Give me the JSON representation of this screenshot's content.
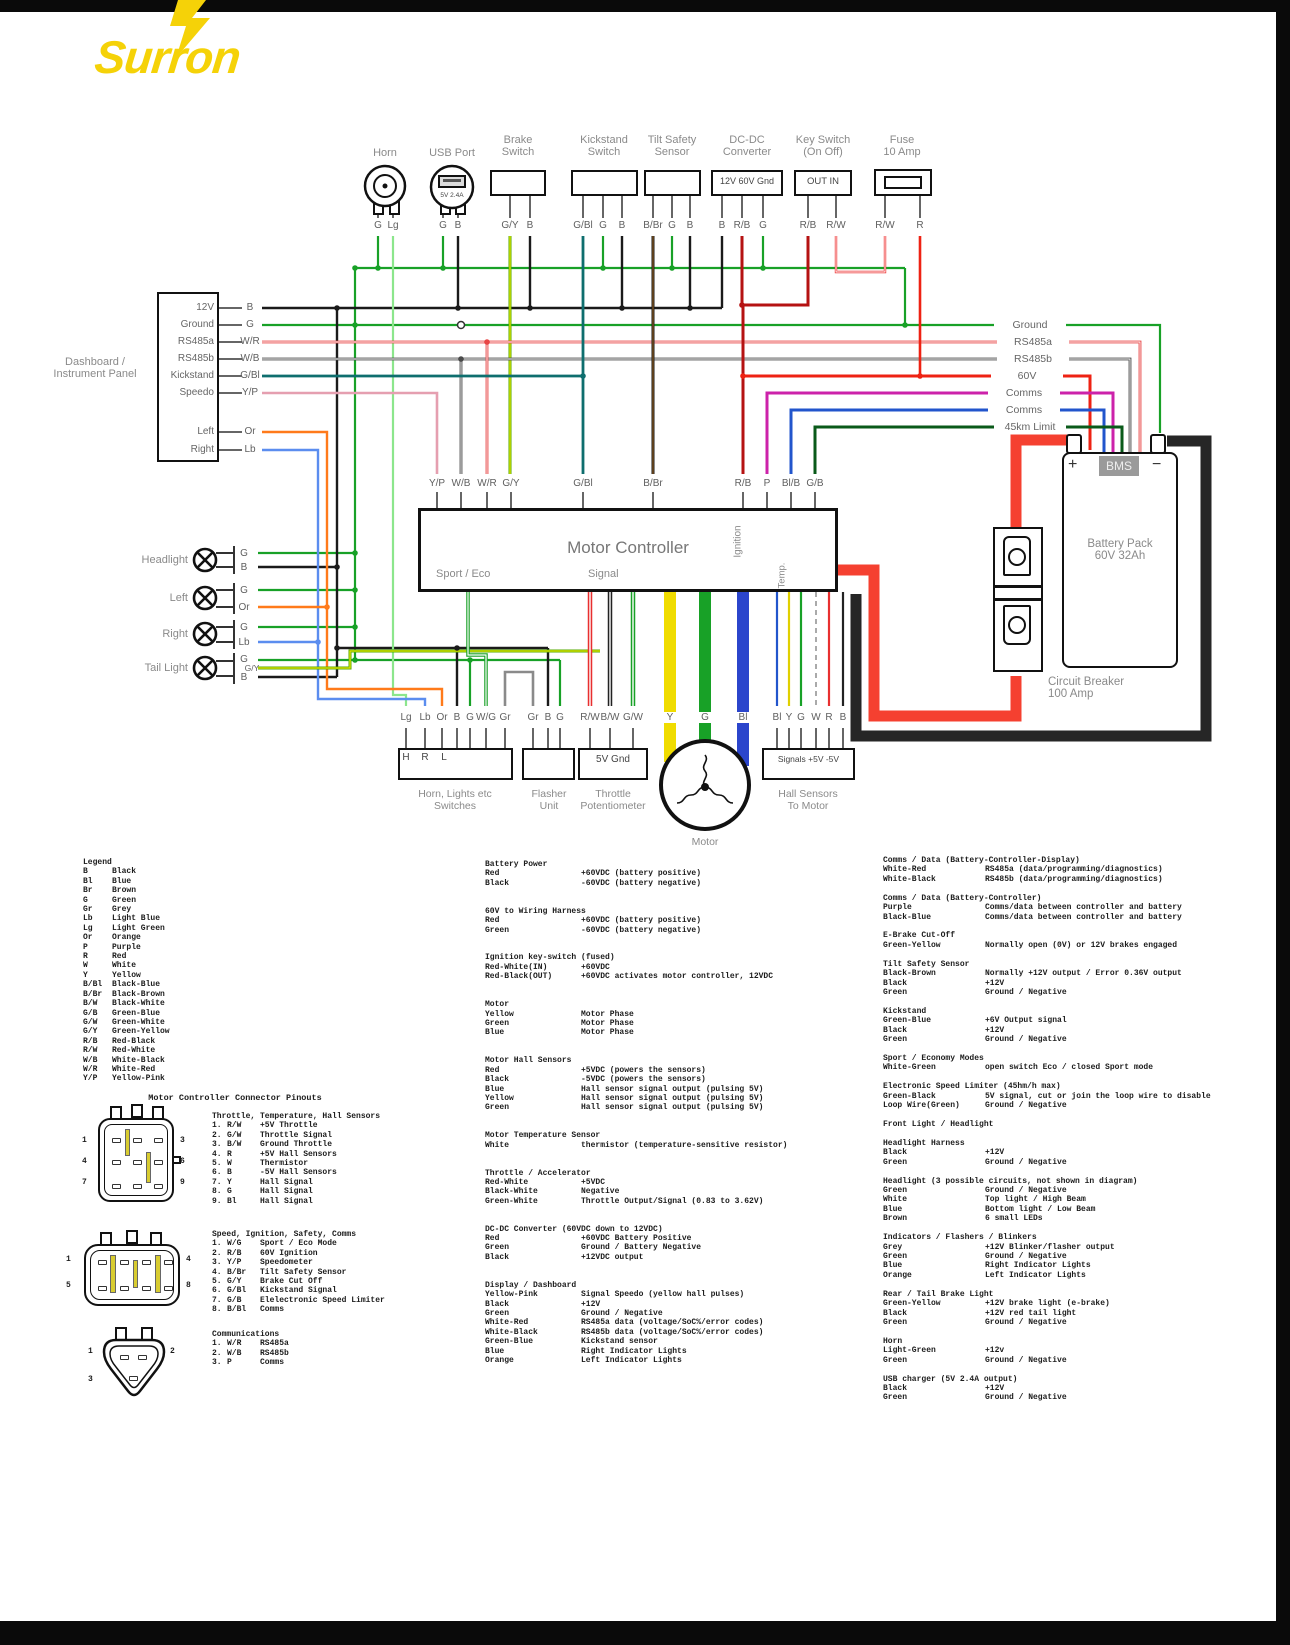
{
  "logo": "Surron",
  "wire_colors": {
    "black": "#1a1a1a",
    "green": "#18a127",
    "light_green": "#8ce68c",
    "light_blue": "#5b8def",
    "orange": "#ff7a1a",
    "red": "#ee2213",
    "dark_red": "#b51212",
    "green_blue": "#0e6e6e",
    "yellow_pink": "#e59fb0",
    "purple": "#cc22aa",
    "blue": "#2255cc",
    "dark_green": "#0a5a1a",
    "grey": "#8a8a8a",
    "yellow": "#f0dc00",
    "brand_yellow": "#f5d208"
  },
  "top_components": [
    {
      "label": "Horn",
      "label2": "",
      "pins": [
        "G",
        "Lg"
      ]
    },
    {
      "label": "USB Port",
      "label2": "",
      "inner": "5V 2.4A",
      "pins": [
        "G",
        "B"
      ]
    },
    {
      "label": "Brake",
      "label2": "Switch",
      "pins": [
        "G/Y",
        "B"
      ]
    },
    {
      "label": "Kickstand",
      "label2": "Switch",
      "pins": [
        "G/Bl",
        "G",
        "B"
      ]
    },
    {
      "label": "Tilt Safety",
      "label2": "Sensor",
      "pins": [
        "B/Br",
        "G",
        "B"
      ]
    },
    {
      "label": "DC-DC",
      "label2": "Converter",
      "inner": "12V 60V Gnd",
      "pins": [
        "B",
        "R/B",
        "G"
      ]
    },
    {
      "label": "Key Switch",
      "label2": "(On Off)",
      "inner": "OUT   IN",
      "pins": [
        "R/B",
        "R/W"
      ]
    },
    {
      "label": "Fuse",
      "label2": "10 Amp",
      "pins": [
        "R/W",
        "R"
      ]
    }
  ],
  "dashboard": {
    "label_line1": "Dashboard /",
    "label_line2": "Instrument Panel",
    "rows": [
      {
        "name": "12V",
        "pin": "B"
      },
      {
        "name": "Ground",
        "pin": "G"
      },
      {
        "name": "RS485a",
        "pin": "W/R"
      },
      {
        "name": "RS485b",
        "pin": "W/B"
      },
      {
        "name": "Kickstand",
        "pin": "G/Bl"
      },
      {
        "name": "Speedo",
        "pin": "Y/P"
      },
      {
        "name": "Left",
        "pin": "Or"
      },
      {
        "name": "Right",
        "pin": "Lb"
      }
    ]
  },
  "lights": [
    {
      "label": "Headlight",
      "pins": [
        "G",
        "B"
      ]
    },
    {
      "label": "Left",
      "pins": [
        "G",
        "Or"
      ]
    },
    {
      "label": "Right",
      "pins": [
        "G",
        "Lb"
      ]
    },
    {
      "label": "Tail Light",
      "pins": [
        "G",
        "G/Y",
        "B"
      ]
    }
  ],
  "bus_labels": [
    "Ground",
    "RS485a",
    "RS485b",
    "60V",
    "Comms",
    "Comms",
    "45km Limit"
  ],
  "controller": {
    "title": "Motor Controller",
    "sport": "Sport / Eco",
    "signal": "Signal",
    "ignition": "Ignition",
    "temp": "Temp.",
    "pins": [
      "Y/P",
      "W/B",
      "W/R",
      "G/Y",
      "G/Bl",
      "B/Br",
      "R/B",
      "P",
      "Bl/B",
      "G/B"
    ]
  },
  "battery": {
    "plus": "+",
    "bms": "BMS",
    "minus": "−",
    "line1": "Battery Pack",
    "line2": "60V 32Ah"
  },
  "breaker": {
    "line1": "Circuit Breaker",
    "line2": "100 Amp"
  },
  "bottom": {
    "switches": {
      "pins": [
        "Lg",
        "Lb",
        "Or",
        "B",
        "G",
        "W/G",
        "Gr"
      ],
      "inner": "H R L",
      "cap1": "Horn, Lights etc",
      "cap2": "Switches"
    },
    "flasher": {
      "pins": [
        "Gr",
        "B",
        "G"
      ],
      "cap1": "Flasher",
      "cap2": "Unit"
    },
    "throttle": {
      "pins": [
        "R/W",
        "B/W",
        "G/W"
      ],
      "inner": "5V Gnd",
      "cap1": "Throttle",
      "cap2": "Potentiometer"
    },
    "motor": {
      "pins": [
        "Y",
        "G",
        "Bl"
      ],
      "cap1": "Motor"
    },
    "hall": {
      "pins": [
        "Bl",
        "Y",
        "G",
        "W",
        "R",
        "B"
      ],
      "inner": "Signals  +5V -5V",
      "cap1": "Hall Sensors",
      "cap2": "To Motor"
    }
  },
  "legend": {
    "title": "Legend",
    "entries": [
      [
        "B",
        "Black"
      ],
      [
        "Bl",
        "Blue"
      ],
      [
        "Br",
        "Brown"
      ],
      [
        "G",
        "Green"
      ],
      [
        "Gr",
        "Grey"
      ],
      [
        "Lb",
        "Light Blue"
      ],
      [
        "Lg",
        "Light Green"
      ],
      [
        "Or",
        "Orange"
      ],
      [
        "P",
        "Purple"
      ],
      [
        "R",
        "Red"
      ],
      [
        "W",
        "White"
      ],
      [
        "Y",
        "Yellow"
      ],
      [
        "B/Bl",
        "Black-Blue"
      ],
      [
        "B/Br",
        "Black-Brown"
      ],
      [
        "B/W",
        "Black-White"
      ],
      [
        "G/B",
        "Green-Blue"
      ],
      [
        "G/W",
        "Green-White"
      ],
      [
        "G/Y",
        "Green-Yellow"
      ],
      [
        "R/B",
        "Red-Black"
      ],
      [
        "R/W",
        "Red-White"
      ],
      [
        "W/B",
        "White-Black"
      ],
      [
        "W/R",
        "White-Red"
      ],
      [
        "Y/P",
        "Yellow-Pink"
      ]
    ]
  },
  "pinouts": {
    "title": "Motor Controller Connector Pinouts",
    "sections": [
      {
        "header": "Throttle, Temperature, Hall Sensors",
        "rows": [
          [
            "1.",
            "R/W",
            "+5V Throttle"
          ],
          [
            "2.",
            "G/W",
            "Throttle Signal"
          ],
          [
            "3.",
            "B/W",
            "Ground Throttle"
          ],
          [
            "4.",
            "R",
            "+5V Hall Sensors"
          ],
          [
            "5.",
            "W",
            "Thermistor"
          ],
          [
            "6.",
            "B",
            "-5V Hall Sensors"
          ],
          [
            "7.",
            "Y",
            "Hall Signal"
          ],
          [
            "8.",
            "G",
            "Hall Signal"
          ],
          [
            "9.",
            "Bl",
            "Hall Signal"
          ]
        ]
      },
      {
        "header": "Speed, Ignition, Safety, Comms",
        "rows": [
          [
            "1.",
            "W/G",
            "Sport / Eco Mode"
          ],
          [
            "2.",
            "R/B",
            "60V Ignition"
          ],
          [
            "3.",
            "Y/P",
            "Speedometer"
          ],
          [
            "4.",
            "B/Br",
            "Tilt Safety Sensor"
          ],
          [
            "5.",
            "G/Y",
            "Brake Cut Off"
          ],
          [
            "6.",
            "G/Bl",
            "Kickstand Signal"
          ],
          [
            "7.",
            "G/B",
            "Elelectronic Speed Limiter"
          ],
          [
            "8.",
            "B/Bl",
            "Comms"
          ]
        ]
      },
      {
        "header": "Communications",
        "rows": [
          [
            "1.",
            "W/R",
            "RS485a"
          ],
          [
            "2.",
            "W/B",
            "RS485b"
          ],
          [
            "3.",
            "P",
            "Comms"
          ]
        ]
      }
    ],
    "connector_numbers": {
      "a": [
        "1",
        "3",
        "4",
        "6",
        "7",
        "9"
      ],
      "b": [
        "1",
        "4",
        "5",
        "8"
      ],
      "c": [
        "1",
        "2",
        "3"
      ]
    }
  },
  "notes_col2": [
    {
      "title": "Battery Power",
      "rows": [
        [
          "Red",
          "+60VDC (battery positive)"
        ],
        [
          "Black",
          "-60VDC (battery negative)"
        ]
      ]
    },
    {
      "title": "60V to Wiring Harness",
      "rows": [
        [
          "Red",
          "+60VDC (battery positive)"
        ],
        [
          "Green",
          "-60VDC (battery negative)"
        ]
      ]
    },
    {
      "title": "Ignition key-switch (fused)",
      "rows": [
        [
          "Red-White(IN)",
          "+60VDC"
        ],
        [
          "Red-Black(OUT)",
          "+60VDC activ­ates motor controller, 12VDC"
        ]
      ]
    },
    {
      "title": "Motor",
      "rows": [
        [
          "Yellow",
          "Motor Phase"
        ],
        [
          "Green",
          "Motor Phase"
        ],
        [
          "Blue",
          "Motor Phase"
        ]
      ]
    },
    {
      "title": "Motor Hall Sensors",
      "rows": [
        [
          "Red",
          "+5VDC (powers the sensors)"
        ],
        [
          "Black",
          "-5VDC (powers the sensors)"
        ],
        [
          "Blue",
          "Hall sensor signal output (pulsing 5V)"
        ],
        [
          "Yellow",
          "Hall sensor signal output (pulsing 5V)"
        ],
        [
          "Green",
          "Hall sensor signal output (pulsing 5V)"
        ]
      ]
    },
    {
      "title": "Motor Temperature Sensor",
      "rows": [
        [
          "White",
          "thermistor (temperature-sensitive resistor)"
        ]
      ]
    },
    {
      "title": "Throttle / Accelerator",
      "rows": [
        [
          "Red-White",
          "+5VDC"
        ],
        [
          "Black-White",
          "Negative"
        ],
        [
          "Green-White",
          "Throttle Output/Signal (0.83 to 3.62V)"
        ]
      ]
    },
    {
      "title": "DC-DC Converter (60VDC down to 12VDC)",
      "rows": [
        [
          "Red",
          "+60VDC Battery Positive"
        ],
        [
          "Green",
          "Ground / Battery Negative"
        ],
        [
          "Black",
          "+12VDC output"
        ]
      ]
    },
    {
      "title": "Display / Dashboard",
      "rows": [
        [
          "Yellow-Pink",
          "Signal Speedo (yellow hall pulses)"
        ],
        [
          "Black",
          "+12V"
        ],
        [
          "Green",
          "Ground / Negative"
        ],
        [
          "White-Red",
          "RS485a data (voltage/SoC%/error codes)"
        ],
        [
          "White-Black",
          "RS485b data (voltage/SoC%/error codes)"
        ],
        [
          "Green-Blue",
          "Kickstand sensor"
        ],
        [
          "Blue",
          "Right Indicator Lights"
        ],
        [
          "Orange",
          "Left Indicator Lights"
        ]
      ]
    }
  ],
  "notes_col3": [
    {
      "title": "Comms / Data (Battery-Controller-Display)",
      "rows": [
        [
          "White-Red",
          "RS485a (data/programming/diagnostics)"
        ],
        [
          "White-Black",
          "RS485b (data/programming/diagnostics)"
        ]
      ]
    },
    {
      "title": "Comms / Data (Battery-Controller)",
      "rows": [
        [
          "Purple",
          "Comms/data between controller and battery"
        ],
        [
          "Black-Blue",
          "Comms/data between controller and battery"
        ]
      ]
    },
    {
      "title": "E-Brake Cut-Off",
      "rows": [
        [
          "Green-Yellow",
          "Normally open (0V) or 12V brakes engaged"
        ]
      ]
    },
    {
      "title": "Tilt Safety Sensor",
      "rows": [
        [
          "Black-Brown",
          "Normally +12V output / Error 0.36V output"
        ],
        [
          "Black",
          "+12V"
        ],
        [
          "Green",
          "Ground / Negative"
        ]
      ]
    },
    {
      "title": "Kickstand",
      "rows": [
        [
          "Green-Blue",
          "+6V Output signal"
        ],
        [
          "Black",
          "+12V"
        ],
        [
          "Green",
          "Ground / Negative"
        ]
      ]
    },
    {
      "title": "Sport / Economy Modes",
      "rows": [
        [
          "White-Green",
          "open switch Eco / closed Sport mode"
        ]
      ]
    },
    {
      "title": "Electronic Speed Limiter (45hm/h max)",
      "rows": [
        [
          "Green-Black",
          "5V signal, cut or join the loop wire to disable"
        ],
        [
          "Loop Wire(Green)",
          "Ground / Negative"
        ]
      ]
    },
    {
      "title": "Front Light / Headlight",
      "rows": []
    },
    {
      "title": "Headlight Harness",
      "rows": [
        [
          "Black",
          "+12V"
        ],
        [
          "Green",
          "Ground / Negative"
        ]
      ]
    },
    {
      "title": "Headlight (3 possible circuits, not shown in diagram)",
      "rows": [
        [
          "Green",
          "Ground / Negative"
        ],
        [
          "White",
          "Top light / High Beam"
        ],
        [
          "Blue",
          "Bottom light / Low Beam"
        ],
        [
          "Brown",
          "6 small LEDs"
        ]
      ]
    },
    {
      "title": "Indicators / Flashers / Blinkers",
      "rows": [
        [
          "Grey",
          "+12V Blinker/flasher output"
        ],
        [
          "Green",
          "Ground / Negative"
        ],
        [
          "Blue",
          "Right Indicator Lights"
        ],
        [
          "Orange",
          "Left Indicator Lights"
        ]
      ]
    },
    {
      "title": "Rear / Tail Brake Light",
      "rows": [
        [
          "Green-Yellow",
          "+12V brake light (e-brake)"
        ],
        [
          "Black",
          "+12V red tail light"
        ],
        [
          "Green",
          "Ground / Negative"
        ]
      ]
    },
    {
      "title": "Horn",
      "rows": [
        [
          "Light-Green",
          "+12v"
        ],
        [
          "Green",
          "Ground / Negative"
        ]
      ]
    },
    {
      "title": "USB charger (5V 2.4A output)",
      "rows": [
        [
          "Black",
          "+12V"
        ],
        [
          "Green",
          "Ground / Negative"
        ]
      ]
    }
  ]
}
